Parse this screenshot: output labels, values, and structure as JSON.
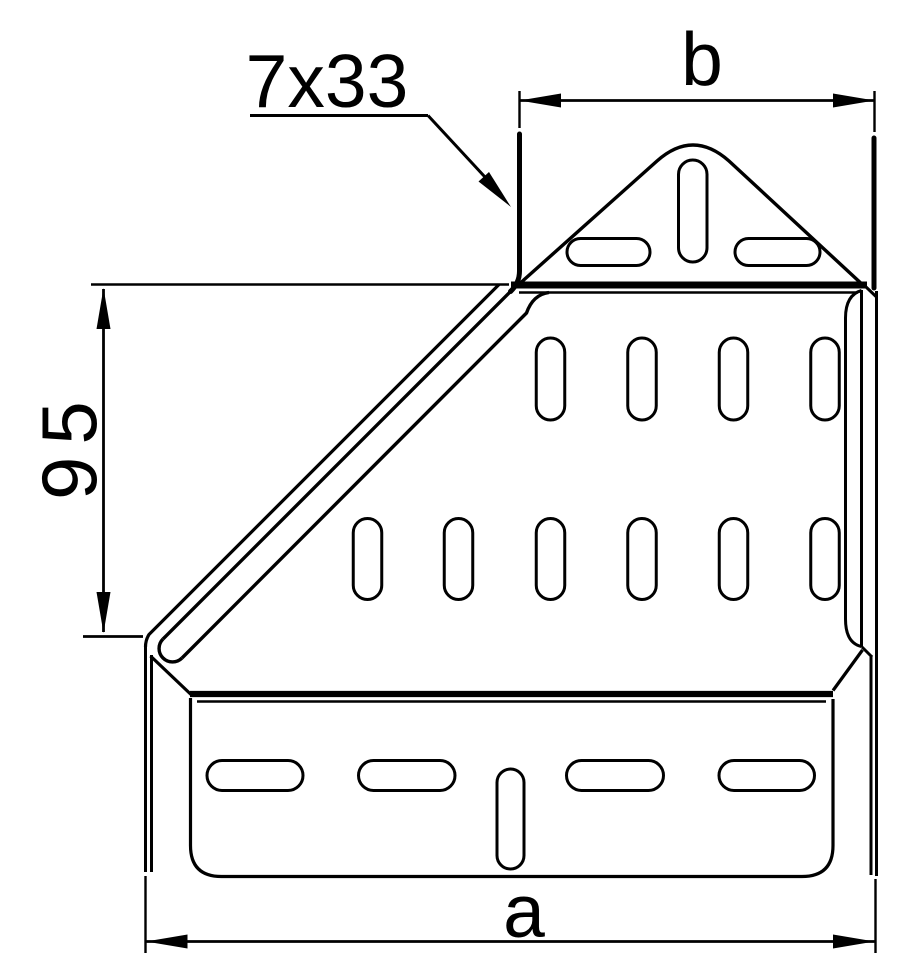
{
  "figure": {
    "title": "Perforated reducer plate - dimensioned line drawing",
    "background_color": "#ffffff",
    "line_color": "#000000"
  },
  "dimensions": {
    "top_width_label": "b",
    "bottom_width_label": "a",
    "left_height_label": "95",
    "slot_callout_label": "7x33"
  },
  "perforations": {
    "top_plate_horizontal_slots": 2,
    "top_plate_vertical_slots": 1,
    "web_upper_row_slots": 4,
    "web_lower_row_slots": 6,
    "bottom_plate_horizontal_slots": 4,
    "bottom_plate_vertical_slots": 1
  }
}
